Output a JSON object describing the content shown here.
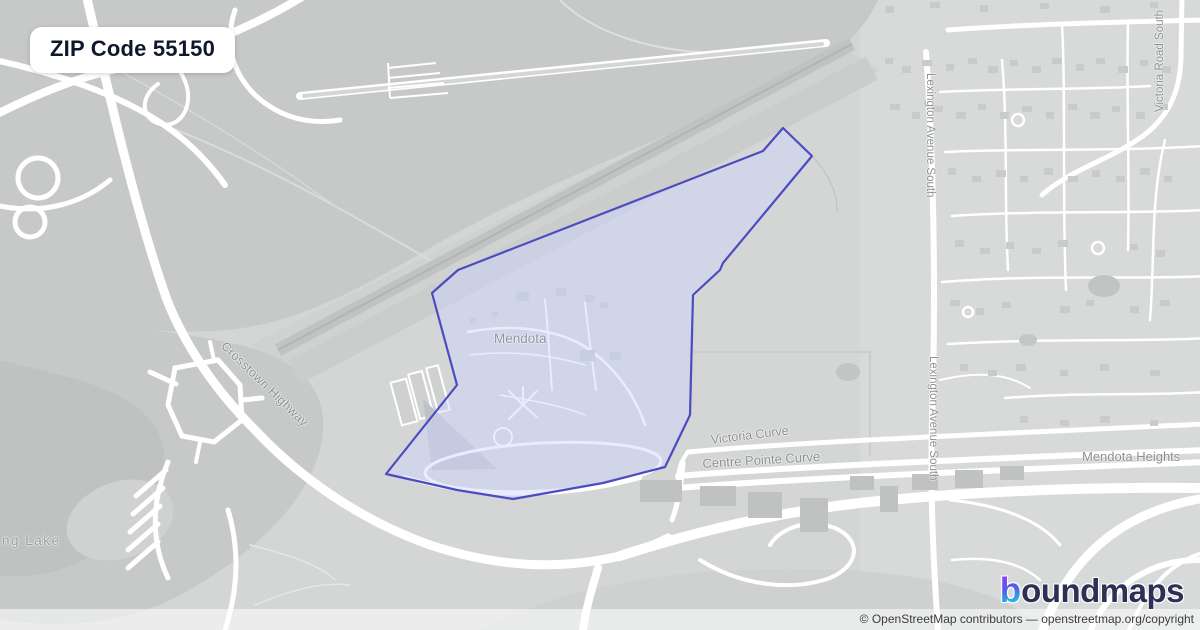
{
  "badge": {
    "label": "ZIP Code 55150"
  },
  "map": {
    "place_labels": [
      {
        "id": "mendota",
        "text": "Mendota"
      },
      {
        "id": "mendota-heights",
        "text": "Mendota Heights"
      },
      {
        "id": "lake-partial",
        "text": "ng Lake"
      }
    ],
    "road_labels": [
      {
        "id": "crosstown-highway",
        "text": "Crosstown Highway"
      },
      {
        "id": "victoria-curve",
        "text": "Victoria Curve"
      },
      {
        "id": "centre-pointe-curve",
        "text": "Centre Pointe Curve"
      },
      {
        "id": "lexington-avenue-south-north",
        "text": "Lexington Avenue South"
      },
      {
        "id": "lexington-avenue-south-south",
        "text": "Lexington Avenue South"
      },
      {
        "id": "victoria-road-south",
        "text": "Victoria Road South"
      }
    ]
  },
  "logo": {
    "icon_letter": "b",
    "wordmark": "oundmaps"
  },
  "attribution": {
    "text": "© OpenStreetMap contributors — openstreetmap.org/copyright"
  },
  "colors": {
    "zip_boundary_stroke": "#4c4cc0",
    "zip_fill": "#cdd4ff",
    "brand_navy": "#2d2f55",
    "brand_purple": "#8a3ffc",
    "brand_teal": "#1ec7e6"
  }
}
